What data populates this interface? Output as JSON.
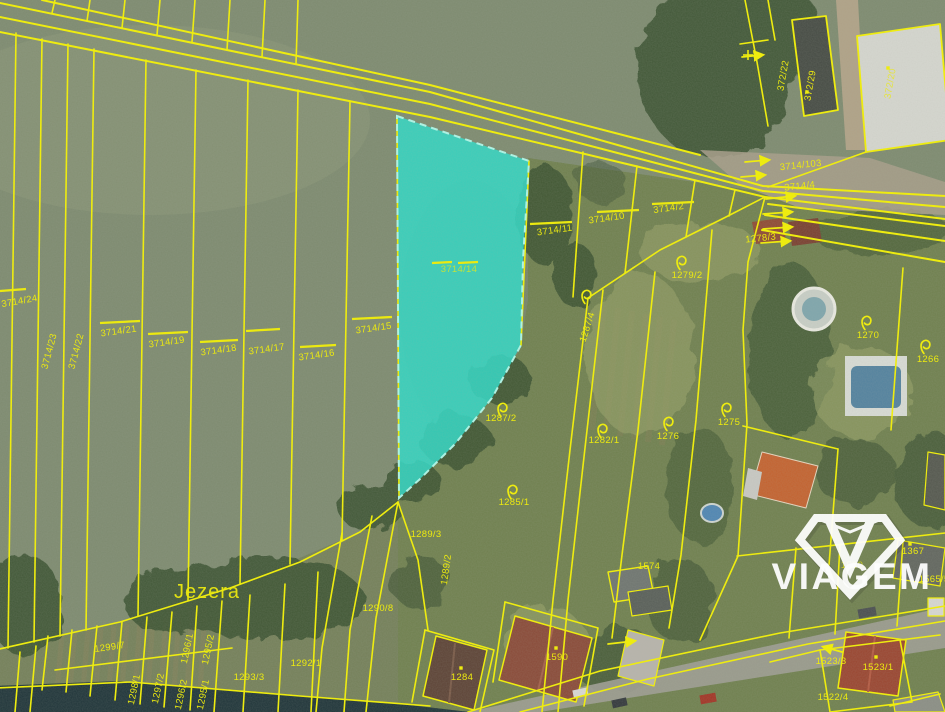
{
  "map_type": "cadastral-parcel-map-over-aerial-imagery",
  "colors": {
    "parcel_line": "#f5f200",
    "highlight_fill": "#2fd9c6",
    "label": "#f2ef00",
    "watermark": "#ffffff"
  },
  "watermark": {
    "brand": "VIAGEM"
  },
  "highlight": {
    "parcel": "3714/14"
  },
  "labels": [
    {
      "text": "3714/24",
      "x": 20,
      "y": 304,
      "r": -10
    },
    {
      "text": "3714/23",
      "x": 52,
      "y": 352,
      "r": -75
    },
    {
      "text": "3714/22",
      "x": 79,
      "y": 352,
      "r": -75
    },
    {
      "text": "3714/21",
      "x": 119,
      "y": 334,
      "r": -8
    },
    {
      "text": "3714/19",
      "x": 167,
      "y": 345,
      "r": -8
    },
    {
      "text": "3714/18",
      "x": 219,
      "y": 353,
      "r": -8
    },
    {
      "text": "3714/17",
      "x": 267,
      "y": 352,
      "r": -8
    },
    {
      "text": "3714/16",
      "x": 317,
      "y": 358,
      "r": -8
    },
    {
      "text": "3714/15",
      "x": 374,
      "y": 331,
      "r": -8
    },
    {
      "text": "3714/14",
      "x": 459,
      "y": 272,
      "r": 0,
      "cls": "dim"
    },
    {
      "text": "3714/11",
      "x": 555,
      "y": 233,
      "r": -8
    },
    {
      "text": "3714/10",
      "x": 607,
      "y": 221,
      "r": -8
    },
    {
      "text": "3714/2",
      "x": 669,
      "y": 211,
      "r": -8
    },
    {
      "text": "3714/103",
      "x": 801,
      "y": 168,
      "r": -6
    },
    {
      "text": "3714/4",
      "x": 800,
      "y": 189,
      "r": -6,
      "size": 8
    },
    {
      "text": "372/22",
      "x": 786,
      "y": 76,
      "r": -80
    },
    {
      "text": "372/29",
      "x": 813,
      "y": 86,
      "r": -80
    },
    {
      "text": "372/20",
      "x": 893,
      "y": 84,
      "r": -80,
      "cls": "dim"
    },
    {
      "text": "1278/3",
      "x": 761,
      "y": 241,
      "r": -6
    },
    {
      "text": "1279/2",
      "x": 687,
      "y": 278
    },
    {
      "text": "1287/4",
      "x": 590,
      "y": 328,
      "r": -72
    },
    {
      "text": "1282/1",
      "x": 604,
      "y": 443
    },
    {
      "text": "1276",
      "x": 668,
      "y": 439
    },
    {
      "text": "1275",
      "x": 729,
      "y": 425
    },
    {
      "text": "1270",
      "x": 868,
      "y": 338
    },
    {
      "text": "1266",
      "x": 928,
      "y": 362
    },
    {
      "text": "1287/2",
      "x": 501,
      "y": 421
    },
    {
      "text": "1285/1",
      "x": 514,
      "y": 505
    },
    {
      "text": "1289/3",
      "x": 426,
      "y": 537
    },
    {
      "text": "1289/2",
      "x": 449,
      "y": 570,
      "r": -82,
      "size": 8.5
    },
    {
      "text": "1290/8",
      "x": 378,
      "y": 611
    },
    {
      "text": "1292/1",
      "x": 306,
      "y": 666
    },
    {
      "text": "1293/3",
      "x": 249,
      "y": 680
    },
    {
      "text": "1299/7",
      "x": 110,
      "y": 650,
      "r": -8
    },
    {
      "text": "1298/1",
      "x": 137,
      "y": 690,
      "r": -78,
      "size": 8.5
    },
    {
      "text": "1297/2",
      "x": 161,
      "y": 689,
      "r": -78,
      "size": 8.5
    },
    {
      "text": "1296/2",
      "x": 184,
      "y": 695,
      "r": -78,
      "size": 8.5
    },
    {
      "text": "1295/1",
      "x": 206,
      "y": 695,
      "r": -78,
      "size": 8.5
    },
    {
      "text": "1296/1",
      "x": 190,
      "y": 649,
      "r": -78,
      "size": 8.5
    },
    {
      "text": "1295/2",
      "x": 211,
      "y": 650,
      "r": -78,
      "size": 8.5
    },
    {
      "text": "1284",
      "x": 462,
      "y": 680
    },
    {
      "text": "1590",
      "x": 557,
      "y": 660
    },
    {
      "text": "1574",
      "x": 649,
      "y": 569
    },
    {
      "text": "1367",
      "x": 913,
      "y": 554
    },
    {
      "text": "1560",
      "x": 852,
      "y": 568,
      "cls": "dim"
    },
    {
      "text": "1565/5",
      "x": 934,
      "y": 582
    },
    {
      "text": "1523/3",
      "x": 831,
      "y": 664
    },
    {
      "text": "1523/1",
      "x": 878,
      "y": 670
    },
    {
      "text": "1522/4",
      "x": 833,
      "y": 700
    },
    {
      "text": "Jezera",
      "x": 207,
      "y": 598,
      "cls": "place"
    }
  ],
  "symbols": {
    "loops": [
      [
        681,
        262
      ],
      [
        586,
        296
      ],
      [
        602,
        430
      ],
      [
        668,
        423
      ],
      [
        726,
        409
      ],
      [
        866,
        322
      ],
      [
        925,
        346
      ],
      [
        502,
        409
      ],
      [
        512,
        491
      ]
    ],
    "dots": [
      [
        461,
        668
      ],
      [
        556,
        648
      ],
      [
        876,
        657
      ],
      [
        910,
        544
      ],
      [
        807,
        92
      ],
      [
        888,
        68
      ]
    ],
    "dashes": [
      [
        0,
        291,
        26,
        289
      ],
      [
        100,
        323,
        140,
        321
      ],
      [
        148,
        334,
        188,
        332
      ],
      [
        200,
        342,
        238,
        340
      ],
      [
        246,
        331,
        280,
        329
      ],
      [
        300,
        347,
        336,
        345
      ],
      [
        352,
        319,
        392,
        317
      ],
      [
        432,
        263,
        452,
        262
      ],
      [
        458,
        263,
        478,
        262
      ],
      [
        530,
        224,
        572,
        222
      ],
      [
        597,
        212,
        639,
        210
      ],
      [
        652,
        204,
        694,
        202
      ]
    ],
    "arrows": [
      [
        766,
        199,
        794,
        196
      ],
      [
        763,
        214,
        791,
        212
      ],
      [
        763,
        229,
        791,
        227
      ],
      [
        761,
        243,
        789,
        241
      ],
      [
        745,
        162,
        768,
        160
      ],
      [
        741,
        177,
        764,
        175
      ],
      [
        608,
        644,
        634,
        641
      ],
      [
        842,
        652,
        824,
        647
      ],
      [
        742,
        57,
        762,
        55
      ]
    ]
  }
}
